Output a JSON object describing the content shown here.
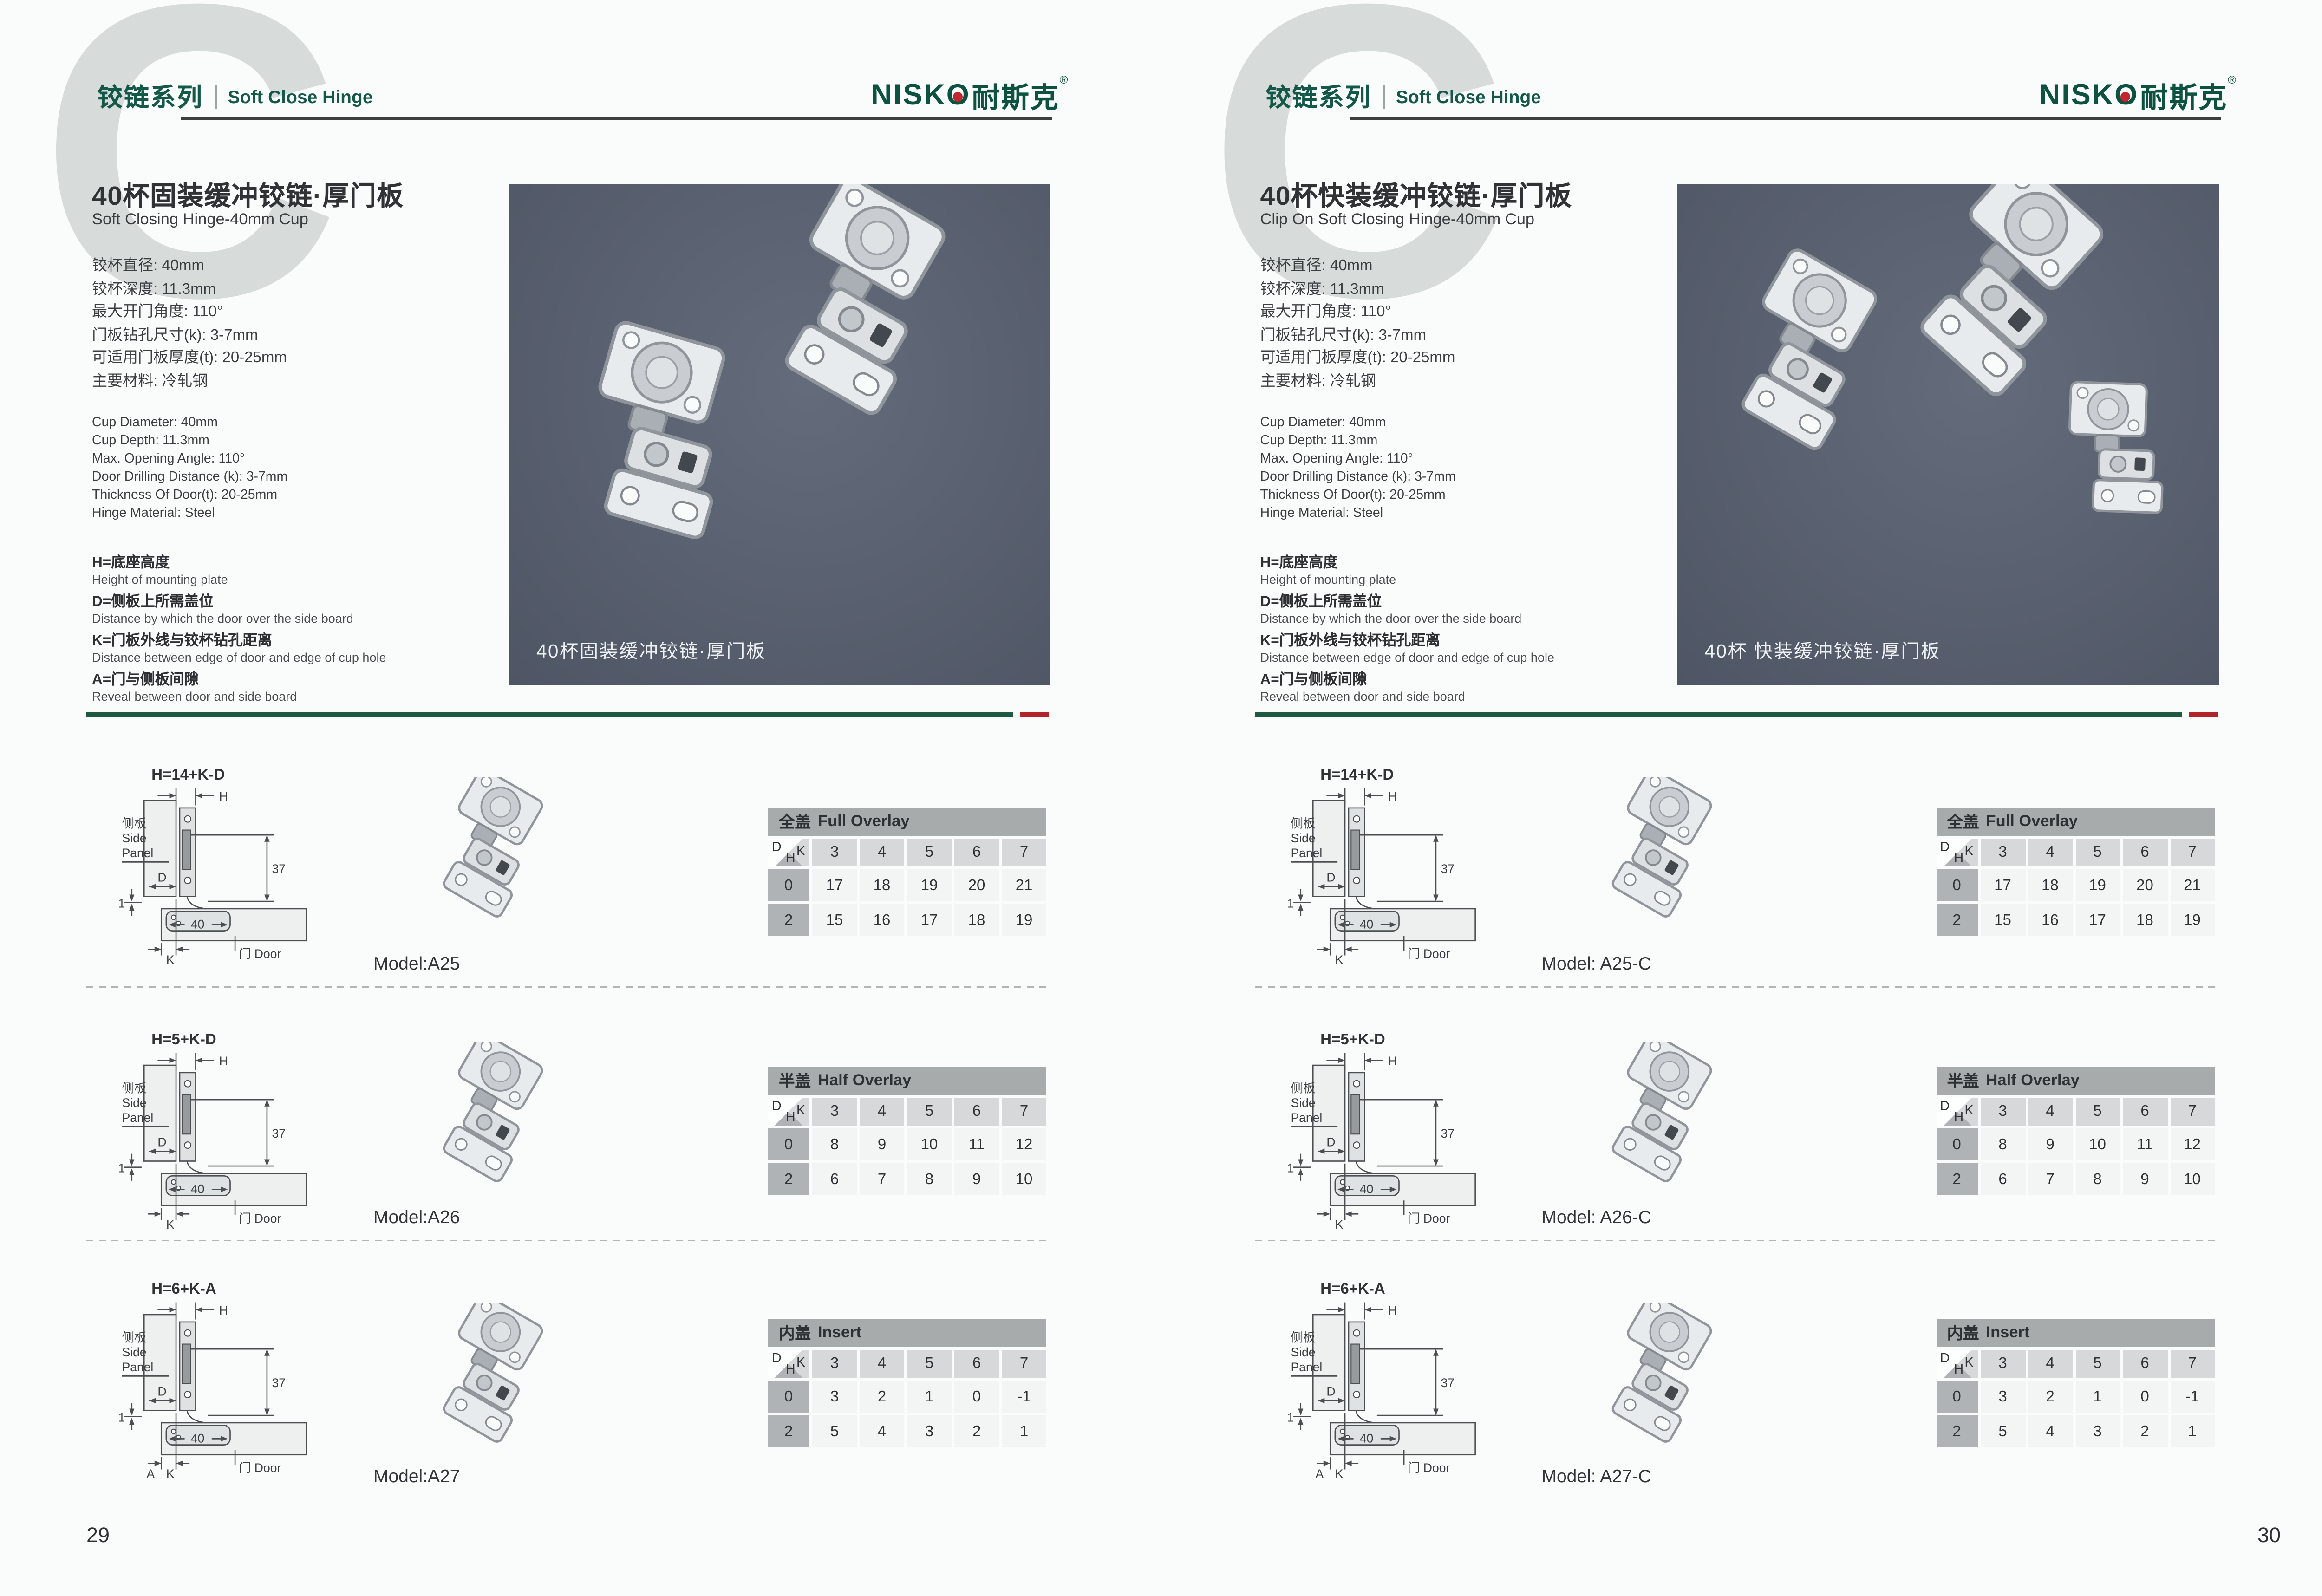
{
  "header": {
    "watermark_letter": "C",
    "series_cn": "铰链系列",
    "series_en": "Soft Close Hinge",
    "brand_latin": "NISKO",
    "brand_cn": "耐斯克",
    "registered": "®"
  },
  "pages": [
    {
      "page_number": "29",
      "title_cn": "40杯固装缓冲铰链·厚门板",
      "title_en": "Soft Closing Hinge-40mm Cup",
      "photo_caption": "40杯固装缓冲铰链·厚门板",
      "models": [
        "Model:A25",
        "Model:A26",
        "Model:A27"
      ]
    },
    {
      "page_number": "30",
      "title_cn": "40杯快装缓冲铰链·厚门板",
      "title_en": "Clip On Soft Closing Hinge-40mm Cup",
      "photo_caption": "40杯 快装缓冲铰链·厚门板",
      "models": [
        "Model: A25-C",
        "Model: A26-C",
        "Model: A27-C"
      ]
    }
  ],
  "specs_cn": [
    "铰杯直径: 40mm",
    "铰杯深度: 11.3mm",
    "最大开门角度: 110°",
    "门板钻孔尺寸(k): 3-7mm",
    "可适用门板厚度(t): 20-25mm",
    "主要材料: 冷轧钢"
  ],
  "specs_en": [
    "Cup Diameter: 40mm",
    "Cup Depth: 11.3mm",
    "Max. Opening Angle: 110°",
    "Door Drilling Distance (k): 3-7mm",
    "Thickness Of Door(t): 20-25mm",
    "Hinge Material: Steel"
  ],
  "legend": [
    {
      "cn": "H=底座高度",
      "en": "Height of mounting plate"
    },
    {
      "cn": "D=侧板上所需盖位",
      "en": "Distance by which the door over the side board"
    },
    {
      "cn": "K=门板外线与铰杯钻孔距离",
      "en": "Distance between edge of door and edge of cup hole"
    },
    {
      "cn": "A=门与侧板间隙",
      "en": "Reveal between door and side board"
    }
  ],
  "corner": {
    "d": "D",
    "k": "K",
    "h": "H"
  },
  "tables": [
    {
      "title_cn": "全盖",
      "title_en": "Full Overlay",
      "k_values": [
        "3",
        "4",
        "5",
        "6",
        "7"
      ],
      "rows": [
        {
          "h": "0",
          "values": [
            "17",
            "18",
            "19",
            "20",
            "21"
          ]
        },
        {
          "h": "2",
          "values": [
            "15",
            "16",
            "17",
            "18",
            "19"
          ]
        }
      ]
    },
    {
      "title_cn": "半盖",
      "title_en": "Half Overlay",
      "k_values": [
        "3",
        "4",
        "5",
        "6",
        "7"
      ],
      "rows": [
        {
          "h": "0",
          "values": [
            "8",
            "9",
            "10",
            "11",
            "12"
          ]
        },
        {
          "h": "2",
          "values": [
            "6",
            "7",
            "8",
            "9",
            "10"
          ]
        }
      ]
    },
    {
      "title_cn": "内盖",
      "title_en": "Insert",
      "k_values": [
        "3",
        "4",
        "5",
        "6",
        "7"
      ],
      "rows": [
        {
          "h": "0",
          "values": [
            "3",
            "2",
            "1",
            "0",
            "-1"
          ]
        },
        {
          "h": "2",
          "values": [
            "5",
            "4",
            "3",
            "2",
            "1"
          ]
        }
      ]
    }
  ],
  "diagrams": [
    {
      "formula": "H=14+K-D"
    },
    {
      "formula": "H=5+K-D"
    },
    {
      "formula": "H=6+K-A",
      "label_a": "A"
    }
  ],
  "diagram_labels": {
    "side_cn": "侧板",
    "side_en1": "Side",
    "side_en2": "Panel",
    "door": "门 Door",
    "h": "H",
    "d": "D",
    "k": "K",
    "dim37": "37",
    "dim40": "40",
    "dim1": "1"
  },
  "colors": {
    "brand_green": "#14584a",
    "separator_green": "#1e5a41",
    "accent_red": "#b22429",
    "photo_panel": "#575e6d"
  }
}
